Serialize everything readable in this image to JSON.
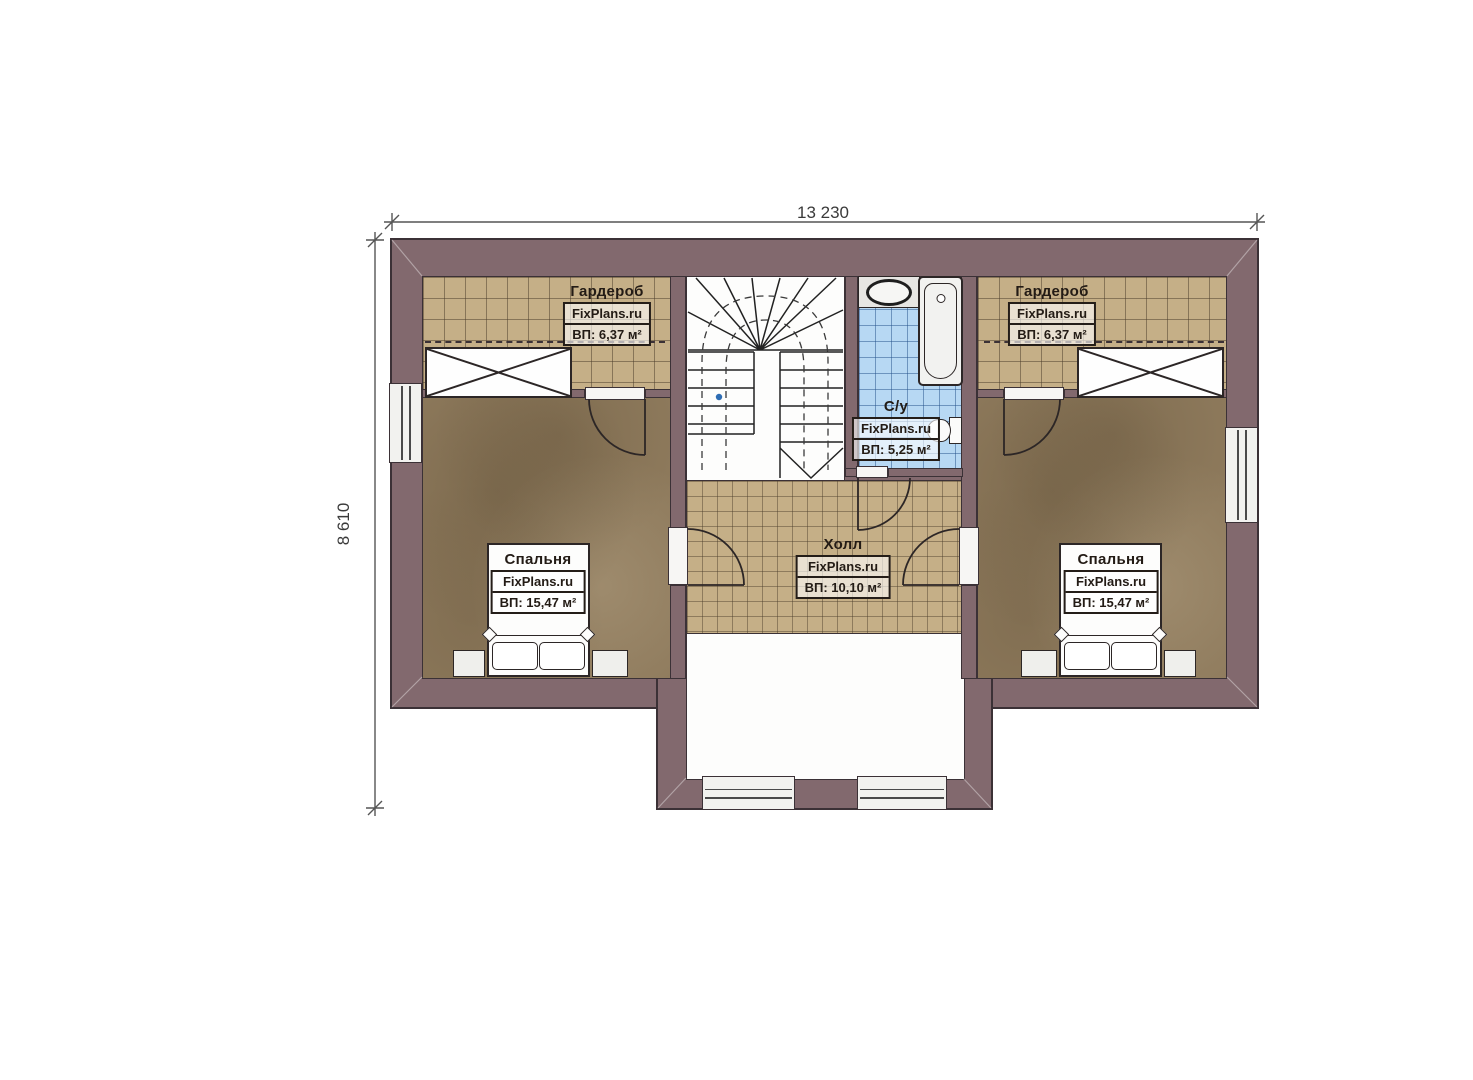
{
  "plan": {
    "type": "floor-plan",
    "dimensions": {
      "width_total": "13 230",
      "height_total": "8 610"
    },
    "rooms": {
      "wardrobe_left": {
        "name": "Гардероб",
        "brand": "FixPlans.ru",
        "area": "ВП: 6,37 м²"
      },
      "wardrobe_right": {
        "name": "Гардероб",
        "brand": "FixPlans.ru",
        "area": "ВП: 6,37 м²"
      },
      "bathroom": {
        "name": "С/у",
        "brand": "FixPlans.ru",
        "area": "ВП: 5,25 м²"
      },
      "hall": {
        "name": "Холл",
        "brand": "FixPlans.ru",
        "area": "ВП: 10,10 м²"
      },
      "bedroom_left": {
        "name": "Спальня",
        "brand": "FixPlans.ru",
        "area": "ВП: 15,47 м²"
      },
      "bedroom_right": {
        "name": "Спальня",
        "brand": "FixPlans.ru",
        "area": "ВП: 15,47 м²"
      }
    },
    "colors": {
      "wall": "#82696e",
      "tile_floor": "#c5af87",
      "bedroom_floor": "#8e7a5c",
      "bathroom_tile": "#b7d8f3",
      "outline": "#3b3136"
    }
  }
}
